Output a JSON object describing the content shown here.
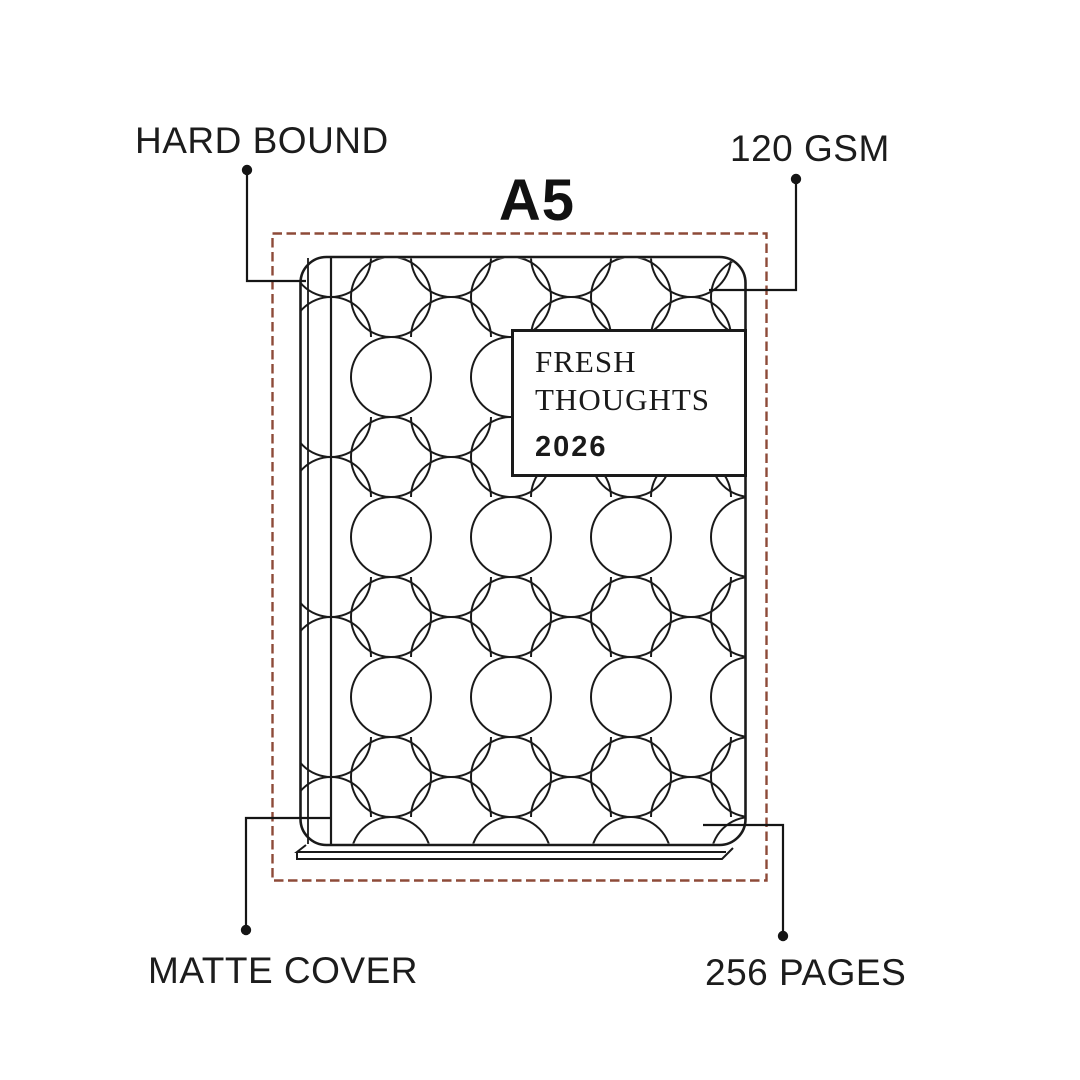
{
  "size_label": "A5",
  "cover": {
    "title_line1": "FRESH",
    "title_line2": "THOUGHTS",
    "year": "2026"
  },
  "callouts": {
    "hard_bound": "HARD BOUND",
    "paper_weight": "120 GSM",
    "matte_cover": "MATTE COVER",
    "page_count": "256 PAGES"
  },
  "colors": {
    "ink": "#1a1a1a",
    "label_text": "#1c1c1c",
    "size_outline_dash": "#8d4a38",
    "background": "#ffffff"
  }
}
